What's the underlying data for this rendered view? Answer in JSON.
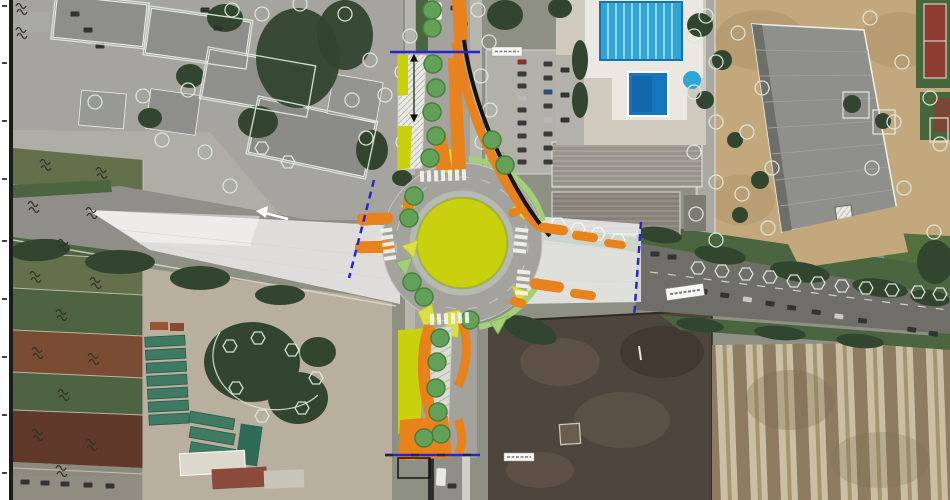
{
  "map": {
    "kind": "aerial-site-plan",
    "features": [
      "roundabout-central-island",
      "roundabout-carriageway",
      "north-approach",
      "south-approach",
      "east-approach",
      "west-approach",
      "design-sidewalk-orange",
      "design-green-verge",
      "design-trees",
      "existing-tree-symbols",
      "section-limit-lines",
      "pedestrian-crossings",
      "swimming-pool-complex",
      "sports-hall",
      "tennis-court",
      "parking-lot",
      "agricultural-fields",
      "storage-yard",
      "vacant-lot",
      "striped-field",
      "street-labels",
      "sheet-margin"
    ],
    "street_label_count": 3
  },
  "colors": {
    "frame-margin": "#ffffff",
    "frame-line": "#1c1c1c",
    "photo-base": "#8d9083",
    "urban-ground": "#a5a49e",
    "road-light": "#a3a29c",
    "road-mid": "#8f8e88",
    "road-dark": "#6f6e68",
    "asphalt-deep": "#55534c",
    "sidewalk": "#b6b5ae",
    "building-roof": "#8e8e8b",
    "building-roof-light": "#b0afaa",
    "building-outline": "#f2f2ee",
    "veg-dark": "#32462f",
    "veg-mid": "#4b6540",
    "grass-green": "#55703f",
    "field-olive": "#63704b",
    "field-green": "#4d6342",
    "field-brown": "#7a4c33",
    "field-brown-dark": "#60392a",
    "field-gray": "#8b8a7c",
    "sand": "#c4a87d",
    "sand-dark": "#a98e66",
    "dirt-dark": "#4e453c",
    "dirt-mottle": "#6b5d4e",
    "stripe-light": "#cabfa4",
    "stripe-dark": "#8d7c60",
    "pool-blue": "#2fa5d6",
    "pool-deep": "#1677bf",
    "pool-deck": "#eae8e1",
    "cad-line": "#dce8dc",
    "design-yellow": "#c9d10e",
    "design-yellow-light": "#d8de43",
    "design-orange": "#e8821c",
    "design-grass": "#a3cf78",
    "tree-green": "#63a058",
    "tree-edge": "#47803f",
    "overlay-white": "#ffffff",
    "section-blue": "#2626cf",
    "shadow-black": "#141414",
    "label-bg": "#f8f8f4",
    "label-line": "#777777"
  }
}
